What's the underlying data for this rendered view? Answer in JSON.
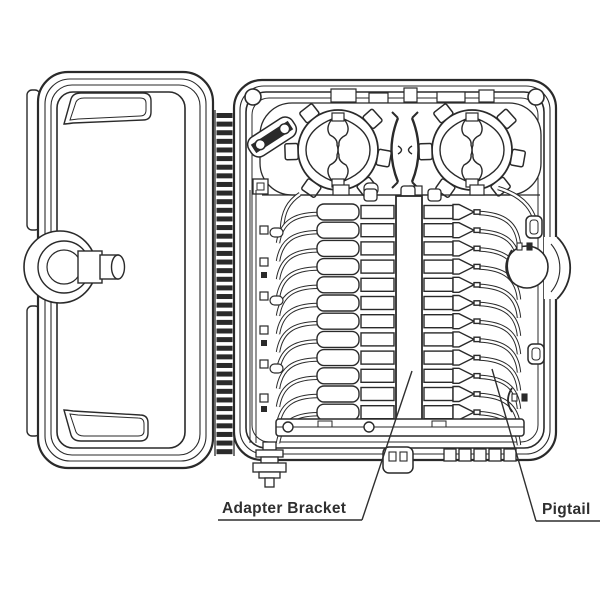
{
  "colors": {
    "background": "#ffffff",
    "ink": "#2a2a2a",
    "label_text": "#2f2f2f"
  },
  "labels": {
    "adapter_bracket": "Adapter Bracket",
    "pigtail": "Pigtail"
  },
  "counts": {
    "adapter_rows": 12,
    "hinge_rungs": 40,
    "fiber_spools": 2,
    "bottom_vents": 5
  }
}
